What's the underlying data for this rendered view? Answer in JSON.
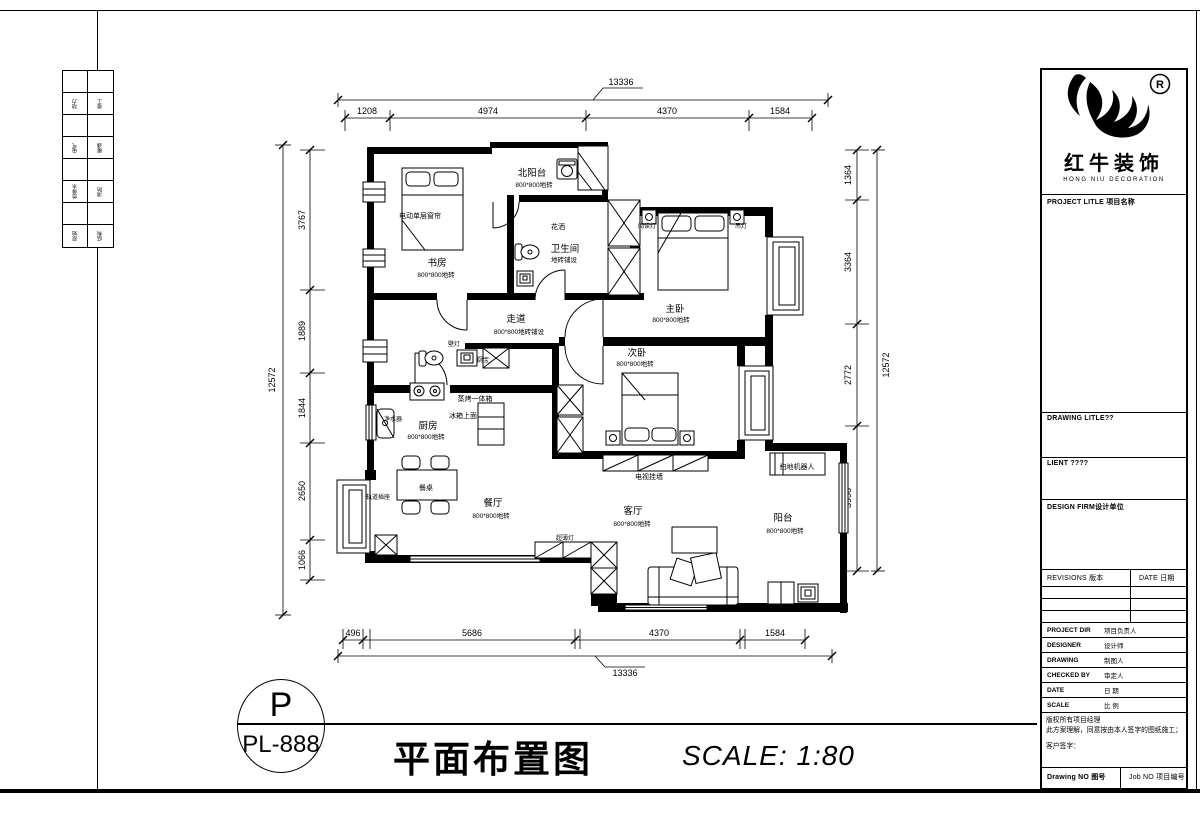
{
  "sheet": {
    "index_tabs": [
      "动力",
      "竣工",
      "电气",
      "暖通",
      "给排水",
      "消防",
      "原始",
      "结构"
    ]
  },
  "logo": {
    "cn": "红牛装饰",
    "en": "HONG NIU DECORATION",
    "reg": "R"
  },
  "titleblock": {
    "project_title": "PROJECT LITLE 项目名称",
    "drawing_title_label": "DRAWING LITLE??",
    "client_label": "LIENT ????",
    "design_firm_label": "DESIGN FIRM设计单位",
    "revisions_label": "REVISIONS 版本",
    "date_col_label": "DATE 日期",
    "rows": [
      {
        "en": "PROJECT DIR",
        "cn": "项目负责人"
      },
      {
        "en": "DESIGNER",
        "cn": "设计师"
      },
      {
        "en": "DRAWING",
        "cn": "制图人"
      },
      {
        "en": "CHECKED BY",
        "cn": "审定人"
      },
      {
        "en": "DATE",
        "cn": "日 期"
      },
      {
        "en": "SCALE",
        "cn": "比 例"
      }
    ],
    "copyright_lines": [
      "版权所有项目经理",
      "此方案理解，同意按由本人签字的图纸施工；",
      "客户签字："
    ],
    "drawing_no_label": "Drawing NO 图号",
    "job_no_label": "Job NO 项目编号"
  },
  "footer": {
    "circle_letter": "P",
    "drawing_no": "PL-888",
    "title": "平面布置图",
    "scale": "SCALE: 1:80"
  },
  "plan": {
    "dims": {
      "top_total": "13336",
      "top_segments": [
        "1208",
        "4974",
        "4370",
        "1584"
      ],
      "bottom_total": "13336",
      "bottom_segments": [
        "496",
        "5686",
        "4370",
        "1584"
      ],
      "left_total": "12572",
      "left_segments": [
        "3767",
        "1889",
        "1844",
        "2650",
        "1066"
      ],
      "right_total": "12572",
      "right_segments": [
        "1364",
        "3364",
        "2772",
        "3956"
      ]
    },
    "rooms": {
      "study": {
        "name": "书房",
        "note": "800*800地转"
      },
      "north_balcony": {
        "name": "北阳台",
        "note": "800*800地转"
      },
      "bathroom": {
        "name": "卫生间",
        "note": "地砖铺设"
      },
      "master_bedroom": {
        "name": "主卧",
        "note": "800*800地转"
      },
      "hallway": {
        "name": "走道",
        "note": "800*800地砖铺设"
      },
      "second_bedroom": {
        "name": "次卧",
        "note": "800*800地转"
      },
      "kitchen": {
        "name": "厨房",
        "note": "800*800地转"
      },
      "dining": {
        "name": "餐厅",
        "note": "800*800地转"
      },
      "living": {
        "name": "客厅",
        "note": "800*800地转"
      },
      "balcony": {
        "name": "阳台",
        "note": "800*800地转"
      }
    },
    "annotations": {
      "curtain": "电动单层窗帘",
      "shower": "花洒",
      "reading_light": "阅读灯",
      "pendant_light": "吊灯",
      "wall_light": "壁灯",
      "kitchen_heater": "厨宝",
      "steam_oven": "蒸烤一体箱",
      "fridge_top": "冰箱上面",
      "water_purifier": "净水器",
      "dining_table": "餐桌",
      "track_socket": "轨道插座",
      "slim_light": "超薄灯",
      "tv_wall": "电视挂墙",
      "robot_vacuum": "扫地机器人"
    }
  }
}
